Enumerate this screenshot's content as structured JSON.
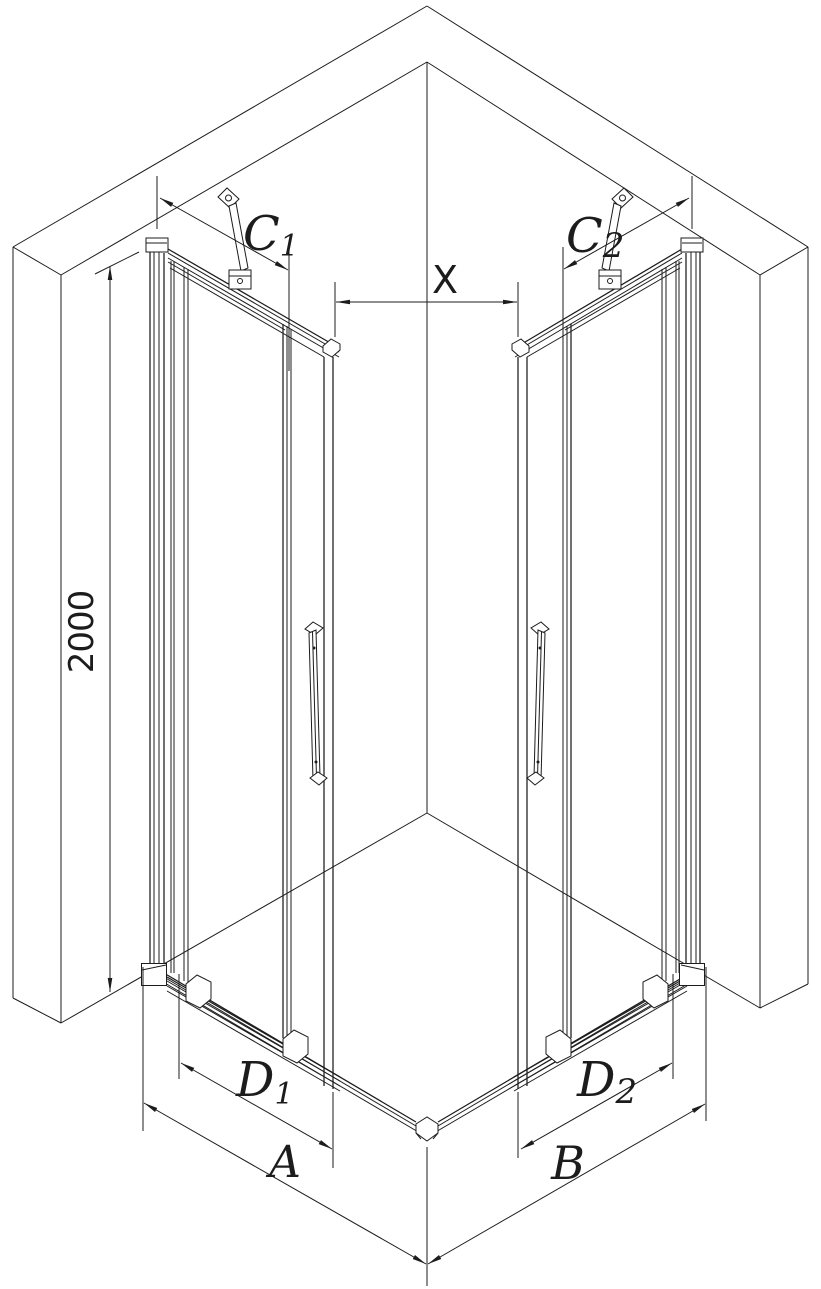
{
  "diagram": {
    "labels": {
      "height": "2000",
      "c1_base": "C",
      "c1_sub": "1",
      "c2_base": "C",
      "c2_sub": "2",
      "entry": "X",
      "d1_base": "D",
      "d1_sub": "1",
      "d2_base": "D",
      "d2_sub": "2",
      "a": "A",
      "b": "B"
    },
    "colors": {
      "line": "#1c1c1c",
      "background": "#ffffff"
    }
  }
}
